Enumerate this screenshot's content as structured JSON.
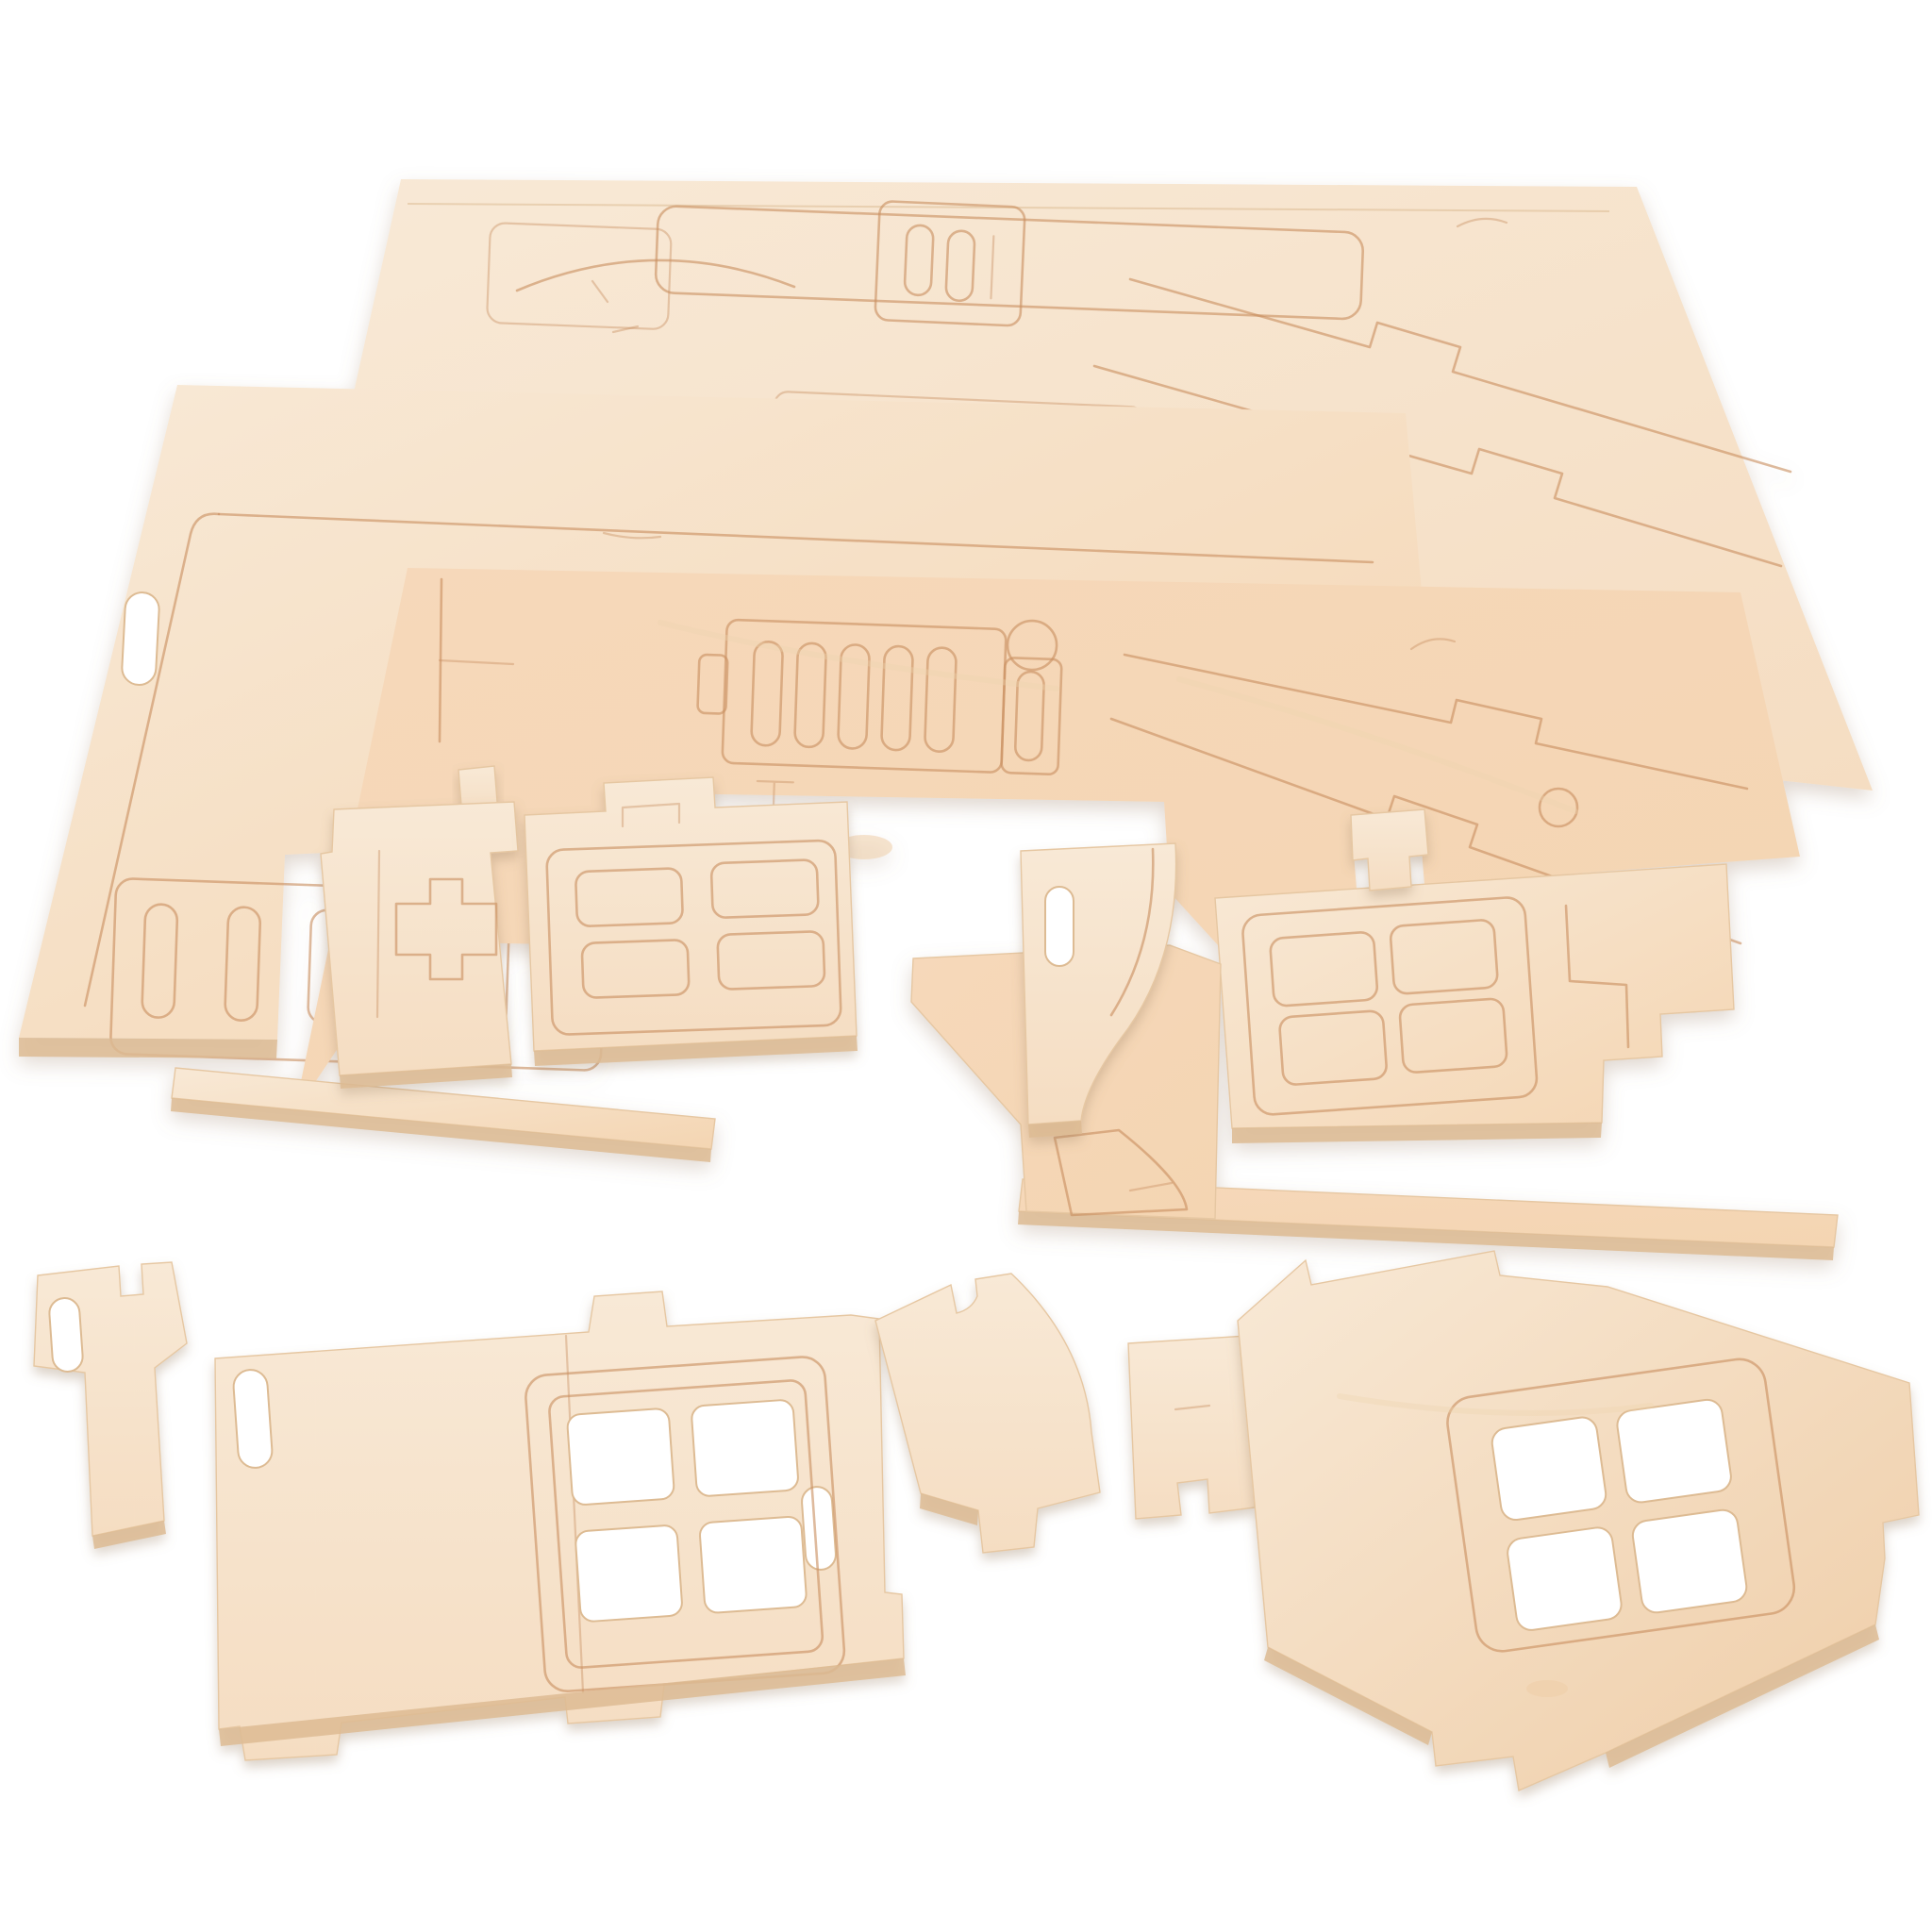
{
  "scene": {
    "title": "Laser-cut plywood 3D puzzle house kit - punch-out sheets and loose pieces on white background",
    "object_type": "wooden 3D puzzle kit",
    "material": "light birch plywood",
    "background": "white seamless studio backdrop",
    "text_visible": "none"
  },
  "colors": {
    "background": "#ffffff",
    "wood_light": "#f8e9d6",
    "wood_mid": "#f5ddc2",
    "wood_warm": "#f4d5b2",
    "wood_deep": "#efcda7",
    "wood_pink": "#f6d8ba",
    "wood_edge": "#ddbb93",
    "wood_edge_dark": "#cfa87e",
    "engrave_line": "#c98f61",
    "grain": "#eed3af"
  },
  "sheets": [
    {
      "name": "back-sheet",
      "engravings": [
        "panel outlines",
        "door arch",
        "chimney with slots",
        "two-pane window",
        "roof panels with tab notches"
      ]
    },
    {
      "name": "middle-sheet",
      "engravings": [
        "margin lines",
        "capsule slot (cut through)",
        "shutter strip with five capsule slots"
      ]
    },
    {
      "name": "front-sheet",
      "engravings": [
        "fence with five slats and round post",
        "roof panel lines",
        "round hole",
        "corner marks",
        "wood knot"
      ]
    }
  ],
  "pieces_on_sheets": [
    {
      "name": "plank-piece",
      "feature": "engraved plus-shaped connector outline"
    },
    {
      "name": "door-piece",
      "feature": "engraved four-pane door window, top tab"
    },
    {
      "name": "arch-piece",
      "feature": "quarter-round arch cut, capsule slot"
    },
    {
      "name": "window-panel-fragment",
      "feature": "engraved four-pane window, stepped cuts"
    },
    {
      "name": "connector-tab",
      "feature": "small interlock tab"
    },
    {
      "name": "frame-strips",
      "feature": "remaining sheet border strips"
    }
  ],
  "loose_pieces": [
    {
      "name": "connector-piece",
      "feature": "hooked head with capsule slot"
    },
    {
      "name": "long-wall-piece",
      "feature": "cut-out four-pane window, two capsule slots, edge tabs"
    },
    {
      "name": "curved-bracket-piece",
      "feature": "curved side, hook notch, foot step"
    },
    {
      "name": "side-plate-piece",
      "feature": "small plate with corner notch"
    },
    {
      "name": "gable-wall-piece",
      "feature": "house-gable pentagon with cut-out four-pane window and edge tabs"
    }
  ]
}
